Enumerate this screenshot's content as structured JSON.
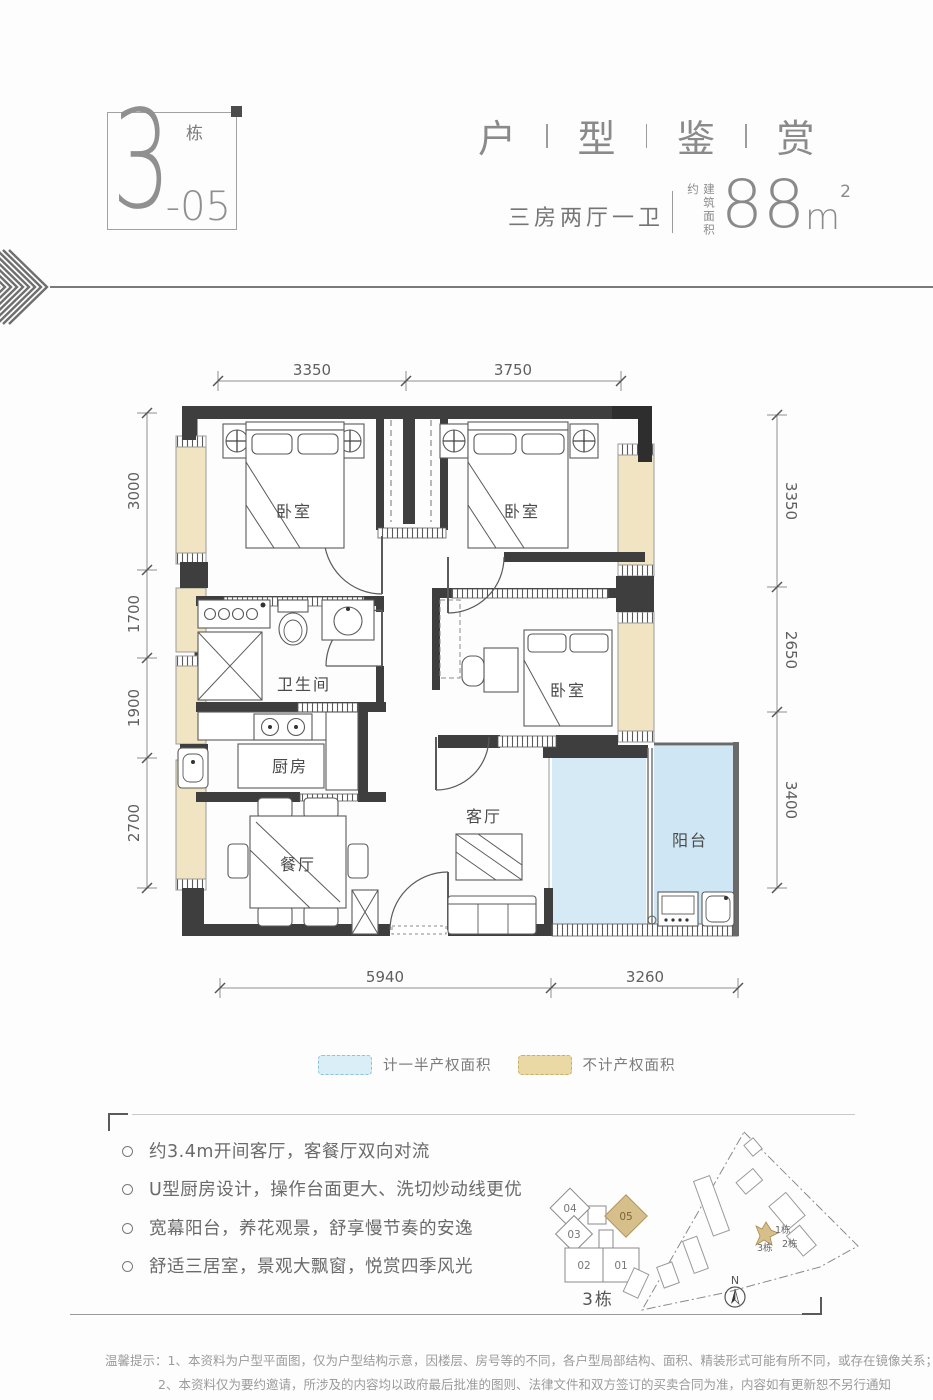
{
  "header": {
    "building_num": "3",
    "building_suffix": "栋",
    "unit_num": "-05",
    "title": [
      "户",
      "型",
      "鉴",
      "赏"
    ],
    "layout_type": "三房两厅一卫",
    "area_prefix": "建筑面积约",
    "area_value": "88",
    "area_unit": "m",
    "area_sup": "2"
  },
  "plan": {
    "rooms": {
      "bedroom1": "卧室",
      "bedroom2": "卧室",
      "bedroom3": "卧室",
      "bathroom": "卫生间",
      "kitchen": "厨房",
      "dining": "餐厅",
      "living": "客厅",
      "balcony": "阳台"
    },
    "dims_top": [
      "3350",
      "3750"
    ],
    "dims_left": [
      "3000",
      "1700",
      "1900",
      "2700"
    ],
    "dims_right": [
      "3350",
      "2650",
      "3400"
    ],
    "dims_bottom": [
      "5940",
      "3260"
    ]
  },
  "legend": {
    "half_area": "计一半产权面积",
    "excluded_area": "不计产权面积"
  },
  "features": [
    "约3.4m开间客厅，客餐厅双向对流",
    "U型厨房设计，操作台面更大、洗切炒动线更优",
    "宽幕阳台，养花观景，舒享慢节奏的安逸",
    "舒适三居室，景观大飘窗，悦赏四季风光"
  ],
  "keyplan": {
    "units": [
      "04",
      "03",
      "05",
      "02",
      "01"
    ],
    "caption": "3栋"
  },
  "siteplan": {
    "labels": [
      "1栋",
      "2栋",
      "3栋"
    ],
    "compass": "N"
  },
  "disclaimer": {
    "line1": "温馨提示：1、本资料为户型平面图，仅为户型结构示意，因楼层、房号等的不同，各户型局部结构、面积、精装形式可能有所不同，或存在镜像关系；",
    "line2": "2、本资料仅为要约邀请，所涉及的内容均以政府最后批准的图则、法律文件和双方签订的买卖合同为准，内容如有更新恕不另行通知"
  },
  "colors": {
    "half_area_fill": "#d6eaf5",
    "excluded_fill": "#f0e4c2",
    "wall": "#3e3e3e",
    "accent_tan": "#d7bf8c"
  }
}
